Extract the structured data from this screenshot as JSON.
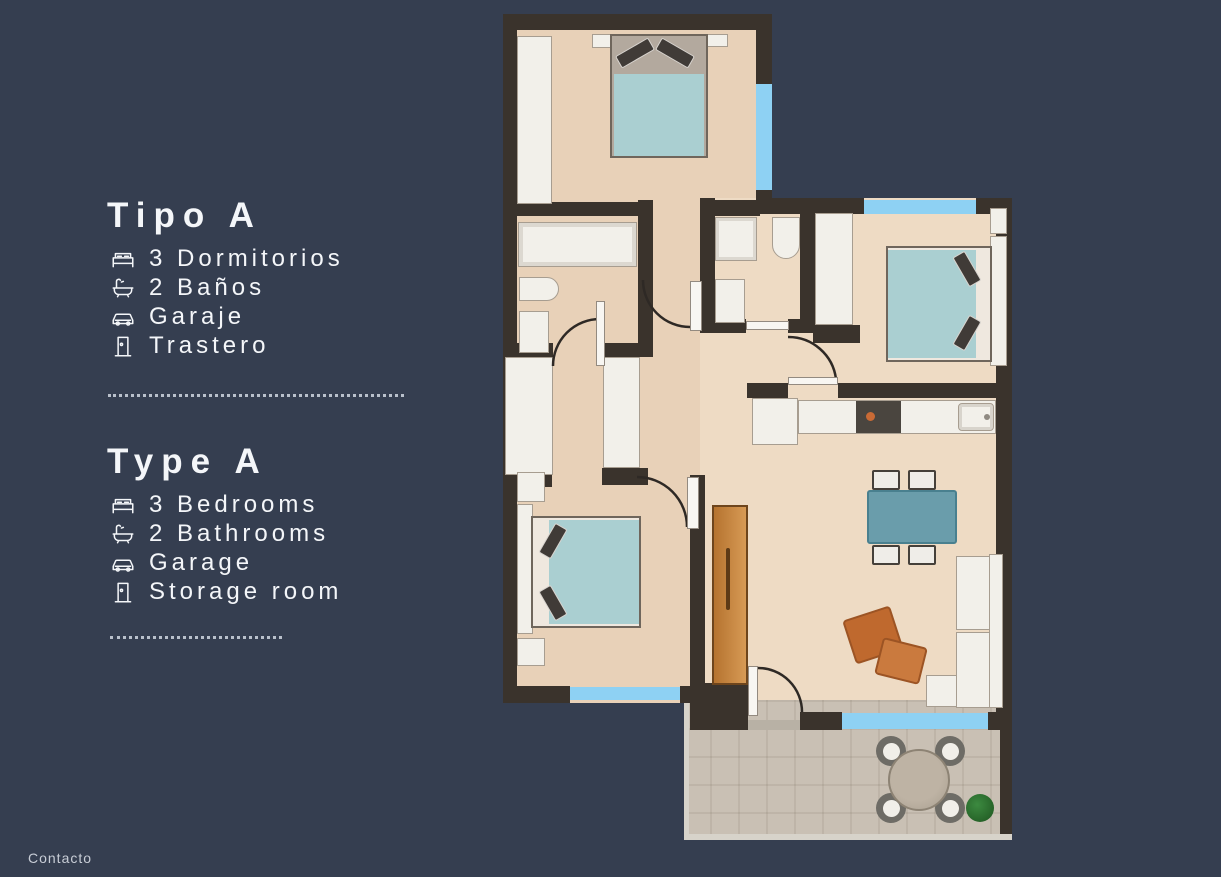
{
  "panel": {
    "spanish": {
      "title": "Tipo A",
      "items": [
        {
          "icon": "bed",
          "label": "3 Dormitorios"
        },
        {
          "icon": "bathtub",
          "label": "2 Baños"
        },
        {
          "icon": "car",
          "label": "Garaje"
        },
        {
          "icon": "door",
          "label": "Trastero"
        }
      ]
    },
    "english": {
      "title": "Type A",
      "items": [
        {
          "icon": "bed",
          "label": "3 Bedrooms"
        },
        {
          "icon": "bathtub",
          "label": "2 Bathrooms"
        },
        {
          "icon": "car",
          "label": "Garage"
        },
        {
          "icon": "door",
          "label": "Storage room"
        }
      ]
    }
  },
  "footer": {
    "contact_label": "Contacto"
  },
  "floorplan": {
    "kind": "apartment floor plan, top-down 3D render, 3 bedrooms, 2 bathrooms, kitchen-living room, terrace",
    "colors": {
      "background": "#353e50",
      "wall": "#3a332c",
      "floor": "#e8d1b8",
      "floor_living": "#eedbc4",
      "terrace": "#c9c0b4",
      "window": "#8ed1f3",
      "bed": "#aacfd1",
      "dining_table": "#6a9dab",
      "armchair": "#bf692e",
      "wood_door": "#c9873f",
      "plant": "#2e7a33"
    }
  }
}
